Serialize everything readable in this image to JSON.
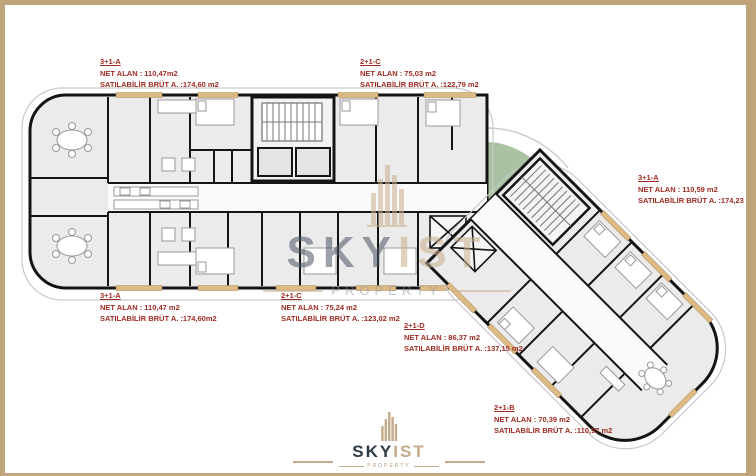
{
  "page": {
    "title": "Skyist Property floor plan",
    "frame_color": "#bfa47c"
  },
  "colors": {
    "label_red": "#9e2b22",
    "wall_black": "#141414",
    "floor_gray": "#ebebeb",
    "window_tan": "#ddba85",
    "courtyard_green": "#a9c2a1",
    "watermark_beige": "#c9ae8e",
    "watermark_navy": "#4a5363"
  },
  "brand": {
    "watermark": {
      "sky": "SKY",
      "ist": "IST",
      "subtitle": "PROPERTY"
    },
    "footer": {
      "sky": "SKY",
      "ist": "IST",
      "subtitle": "PROPERTY"
    }
  },
  "units": [
    {
      "code": "3+1-A",
      "net_alan": "NET ALAN : 110,47m2",
      "brut": "SATILABİLİR BRÜT A. :174,60 m2"
    },
    {
      "code": "2+1-C",
      "net_alan": "NET ALAN : 75,03 m2",
      "brut": "SATILABİLİR BRÜT A. :122,79 m2"
    },
    {
      "code": "3+1-A",
      "net_alan": "NET ALAN : 110,59 m2",
      "brut": "SATILABİLİR BRÜT A. :174,23 m2"
    },
    {
      "code": "3+1-A",
      "net_alan": "NET ALAN : 110,47 m2",
      "brut": "SATILABİLİR BRÜT A. :174,60m2"
    },
    {
      "code": "2+1-C",
      "net_alan": "NET ALAN : 75,24 m2",
      "brut": "SATILABİLİR BRÜT A. :123,02 m2"
    },
    {
      "code": "2+1-D",
      "net_alan": "NET ALAN : 86,37 m2",
      "brut": "SATILABİLİR BRÜT A. :137,15 m2"
    },
    {
      "code": "2+1-B",
      "net_alan": "NET ALAN : 70,39 m2",
      "brut": "SATILABİLİR BRÜT A. :110,97 m2"
    }
  ]
}
